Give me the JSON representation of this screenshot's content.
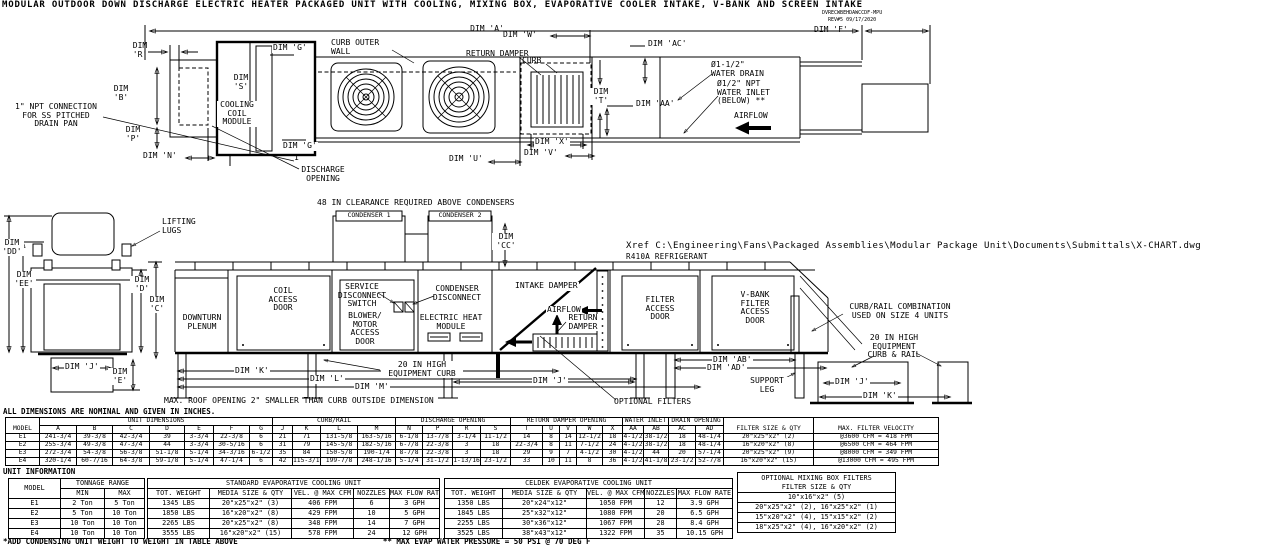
{
  "title": "MODULAR OUTDOOR DOWN DISCHARGE ELECTRIC HEATER PACKAGED UNIT WITH COOLING, MIXING BOX, EVAPORATIVE COOLER INTAKE, V-BANK AND SCREEN INTAKE",
  "title_block": {
    "code": "DVRECWBEHDAWCCDF-MPU",
    "rev": "REV#5  09/17/2020"
  },
  "top_view": {
    "dim_a": "DIM 'A'",
    "dim_w": "DIM 'W'",
    "dim_f": "DIM 'F'",
    "dim_ac": "DIM 'AC'",
    "dim_aa": "DIM 'AA'",
    "dim_r": "DIM\n'R'",
    "dim_b": "DIM\n'B'",
    "dim_p": "DIM\n'P'",
    "dim_n": "DIM 'N'",
    "dim_s": "DIM\n'S'",
    "dim_t": "DIM\n'T'",
    "dim_u": "DIM 'U'",
    "dim_v": "DIM 'V'",
    "dim_x": "DIM 'X'",
    "dim_g_top": "DIM 'G'",
    "dim_g_bottom": "DIM 'G'",
    "section_mark": "1",
    "curb_outer_wall": "CURB OUTER\nWALL",
    "curb": "CURB",
    "return_damper": "RETURN DAMPER",
    "cooling_coil_module": "COOLING\nCOIL\nMODULE",
    "npt_drain": "1\" NPT CONNECTION\nFOR SS PITCHED\nDRAIN PAN",
    "discharge_opening": "DISCHARGE\nOPENING",
    "water_drain": "Ø1-1/2\"\nWATER DRAIN",
    "water_inlet": "Ø1/2\" NPT\nWATER INLET\n(BELOW) **",
    "airflow": "AIRFLOW"
  },
  "side_view": {
    "clearance_note": "48 IN CLEARANCE REQUIRED ABOVE CONDENSERS",
    "condenser_1": "CONDENSER 1",
    "condenser_2": "CONDENSER 2",
    "lifting_lugs": "LIFTING\nLUGS",
    "dim_dd": "DIM\n'DD'",
    "dim_ee": "DIM\n'EE'",
    "dim_d": "DIM\n'D'",
    "dim_c": "DIM\n'C'",
    "dim_cc": "DIM\n'CC'",
    "dim_e": "DIM\n'E'",
    "dim_j_end": "DIM 'J'",
    "xref": "Xref C:\\Engineering\\Fans\\Packaged Assemblies\\Modular Package Unit\\Documents\\Submittals\\X-CHART.dwg",
    "refrigerant": "R410A REFRIGERANT",
    "downturn_plenum": "DOWNTURN\nPLENUM",
    "coil_access_door": "COIL\nACCESS\nDOOR",
    "service_disconnect": "SERVICE\nDISCONNECT\nSWITCH",
    "blower_motor_door": "BLOWER/\nMOTOR\nACCESS\nDOOR",
    "condenser_disconnect": "CONDENSER\nDISCONNECT",
    "electric_heat_module": "ELECTRIC HEAT\nMODULE",
    "intake_damper": "INTAKE DAMPER",
    "airflow": "AIRFLOW",
    "return_damper": "RETURN\nDAMPER",
    "filter_access_door": "FILTER\nACCESS\nDOOR",
    "vbank_filter_door": "V-BANK\nFILTER\nACCESS\nDOOR",
    "equipment_curb": "20 IN HIGH\nEQUIPMENT CURB",
    "curb_rail_combo": "CURB/RAIL COMBINATION\nUSED ON SIZE 4 UNITS",
    "equipment_curb_rail": "20 IN HIGH\nEQUIPMENT\nCURB & RAIL",
    "dim_k": "DIM 'K'",
    "dim_l": "DIM 'L'",
    "dim_m": "DIM 'M'",
    "dim_j": "DIM 'J'",
    "dim_ab": "DIM 'AB'",
    "dim_ad": "DIM 'AD'",
    "support_leg": "SUPPORT\nLEG",
    "optional_filters": "OPTIONAL FILTERS",
    "dim_j_detail": "DIM 'J'",
    "dim_k_detail": "DIM 'K'",
    "max_roof_note": "MAX. ROOF OPENING 2\" SMALLER THAN CURB OUTSIDE DIMENSION"
  },
  "dim_table": {
    "note": "ALL DIMENSIONS ARE NOMINAL AND GIVEN IN INCHES.",
    "model_header": "MODEL",
    "groups": [
      {
        "label": "UNIT DIMENSIONS"
      },
      {
        "label": "CURB/RAIL"
      },
      {
        "label": "DISCHARGE OPENING"
      },
      {
        "label": "RETURN DAMPER OPENING"
      },
      {
        "label": "WATER INLET"
      },
      {
        "label": "DRAIN OPENING"
      }
    ],
    "letters": [
      "A",
      "B",
      "C",
      "D",
      "E",
      "F",
      "G",
      "J",
      "K",
      "L",
      "M",
      "N",
      "P",
      "R",
      "S",
      "T",
      "U",
      "V",
      "W",
      "X",
      "AA",
      "AB",
      "AC",
      "AD"
    ],
    "filter_header": "FILTER SIZE & QTY",
    "velocity_header": "MAX. FILTER VELOCITY",
    "rows": [
      [
        "E1",
        "241-3/4",
        "39-3/8",
        "42-3/4",
        "39",
        "3-3/4",
        "22-3/8",
        "6",
        "21",
        "71",
        "131-5/8",
        "163-5/16",
        "6-1/8",
        "13-7/8",
        "3-1/4",
        "11-1/2",
        "14",
        "8",
        "14",
        "12-1/2",
        "18",
        "4-1/2",
        "38-1/2",
        "18",
        "48-1/4",
        "20\"x25\"x2\" (2)",
        "@3600 CFM = 418 FPM"
      ],
      [
        "E2",
        "255-3/4",
        "49-3/8",
        "47-3/4",
        "44",
        "3-3/4",
        "30-5/16",
        "6",
        "31",
        "79",
        "145-5/8",
        "182-5/16",
        "6-7/8",
        "22-3/8",
        "3",
        "18",
        "22-3/4",
        "8",
        "11",
        "7-1/2",
        "24",
        "4-1/2",
        "38-1/2",
        "18",
        "48-1/4",
        "16\"x20\"x2\" (8)",
        "@6500 CFM = 464 FPM"
      ],
      [
        "E3",
        "272-3/4",
        "54-3/8",
        "56-3/8",
        "51-1/8",
        "5-1/4",
        "34-3/16",
        "6-1/2",
        "35",
        "84",
        "150-5/8",
        "190-1/4",
        "8-7/8",
        "22-3/8",
        "3",
        "18",
        "29",
        "9",
        "7",
        "4-1/2",
        "30",
        "4-1/2",
        "44",
        "20",
        "57-1/4",
        "20\"x25\"x2\" (9)",
        "@8000 CFM = 349 FPM"
      ],
      [
        "E4",
        "320-1/4",
        "60-7/16",
        "64-3/8",
        "59-1/8",
        "5-1/4",
        "47-1/4",
        "6",
        "42",
        "115-3/16",
        "199-7/8",
        "248-1/16",
        "5-1/4",
        "31-1/2",
        "1-13/16",
        "23-1/2",
        "33",
        "10",
        "11",
        "8",
        "36",
        "4-1/2",
        "41-1/8",
        "23-1/2",
        "52-7/8",
        "16\"x20\"x2\" (15)",
        "@13000 CFM = 495 FPM"
      ]
    ]
  },
  "unit_info": {
    "section_title": "UNIT INFORMATION",
    "model_header": "MODEL",
    "tonnage_group": "TONNAGE RANGE",
    "min_header": "MIN",
    "max_header": "MAX",
    "rows": [
      [
        "E1",
        "2 Ton",
        "5 Ton"
      ],
      [
        "E2",
        "5 Ton",
        "10 Ton"
      ],
      [
        "E3",
        "10 Ton",
        "10 Ton"
      ],
      [
        "E4",
        "10 Ton",
        "10 Ton"
      ]
    ]
  },
  "standard_evap": {
    "group": "STANDARD EVAPORATIVE COOLING UNIT",
    "cols": [
      "TOT. WEIGHT",
      "MEDIA SIZE & QTY",
      "VEL. @ MAX CFM",
      "NOZZLES",
      "MAX FLOW RATE"
    ],
    "rows": [
      [
        "1345 LBS",
        "20\"x25\"x2\" (3)",
        "406 FPM",
        "6",
        "3 GPH"
      ],
      [
        "1850 LBS",
        "16\"x20\"x2\" (8)",
        "429 FPM",
        "10",
        "5 GPH"
      ],
      [
        "2265 LBS",
        "20\"x25\"x2\" (8)",
        "348 FPM",
        "14",
        "7 GPH"
      ],
      [
        "3555 LBS",
        "16\"x20\"x2\" (15)",
        "578 FPM",
        "24",
        "12 GPH"
      ]
    ]
  },
  "celdek_evap": {
    "group": "CELDEK EVAPORATIVE COOLING UNIT",
    "cols": [
      "TOT. WEIGHT",
      "MEDIA SIZE & QTY",
      "VEL. @ MAX CFM",
      "NOZZLES",
      "MAX FLOW RATE"
    ],
    "rows": [
      [
        "1350 LBS",
        "20\"x24\"x12\"",
        "1050 FPM",
        "12",
        "3.9 GPH"
      ],
      [
        "1845 LBS",
        "25\"x32\"x12\"",
        "1080 FPM",
        "20",
        "6.5 GPH"
      ],
      [
        "2255 LBS",
        "30\"x36\"x12\"",
        "1067 FPM",
        "28",
        "8.4 GPH"
      ],
      [
        "3525 LBS",
        "38\"x43\"x12\"",
        "1322 FPM",
        "35",
        "10.15 GPH"
      ]
    ]
  },
  "mixing_box": {
    "header_line1": "OPTIONAL MIXING BOX FILTERS",
    "header_line2": "FILTER SIZE & QTY",
    "rows": [
      "10\"x16\"x2\" (5)",
      "20\"x25\"x2\" (2), 16\"x25\"x2\" (1)",
      "15\"x20\"x2\" (4), 15\"x15\"x2\" (2)",
      "18\"x25\"x2\" (4), 16\"x20\"x2\" (2)"
    ]
  },
  "footnotes": {
    "weight_note": "*ADD CONDENSING UNIT WEIGHT TO WEIGHT IN TABLE ABOVE",
    "pressure_note": "** MAX EVAP WATER PRESSURE = 50 PSI @ 70 DEG F"
  }
}
